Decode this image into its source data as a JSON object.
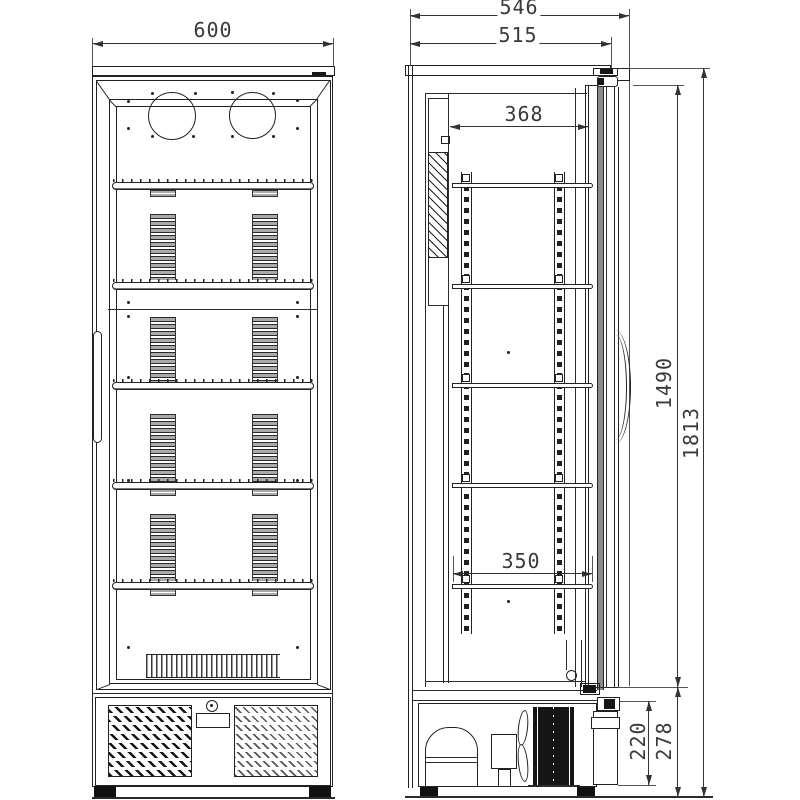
{
  "dimensions": {
    "front_width": "600",
    "overall_depth": "546",
    "body_depth": "515",
    "interior_clear_depth": "368",
    "shelf_depth": "350",
    "door_height": "1490",
    "overall_height": "1813",
    "machine_compartment_height": "220",
    "base_section_height": "278"
  }
}
